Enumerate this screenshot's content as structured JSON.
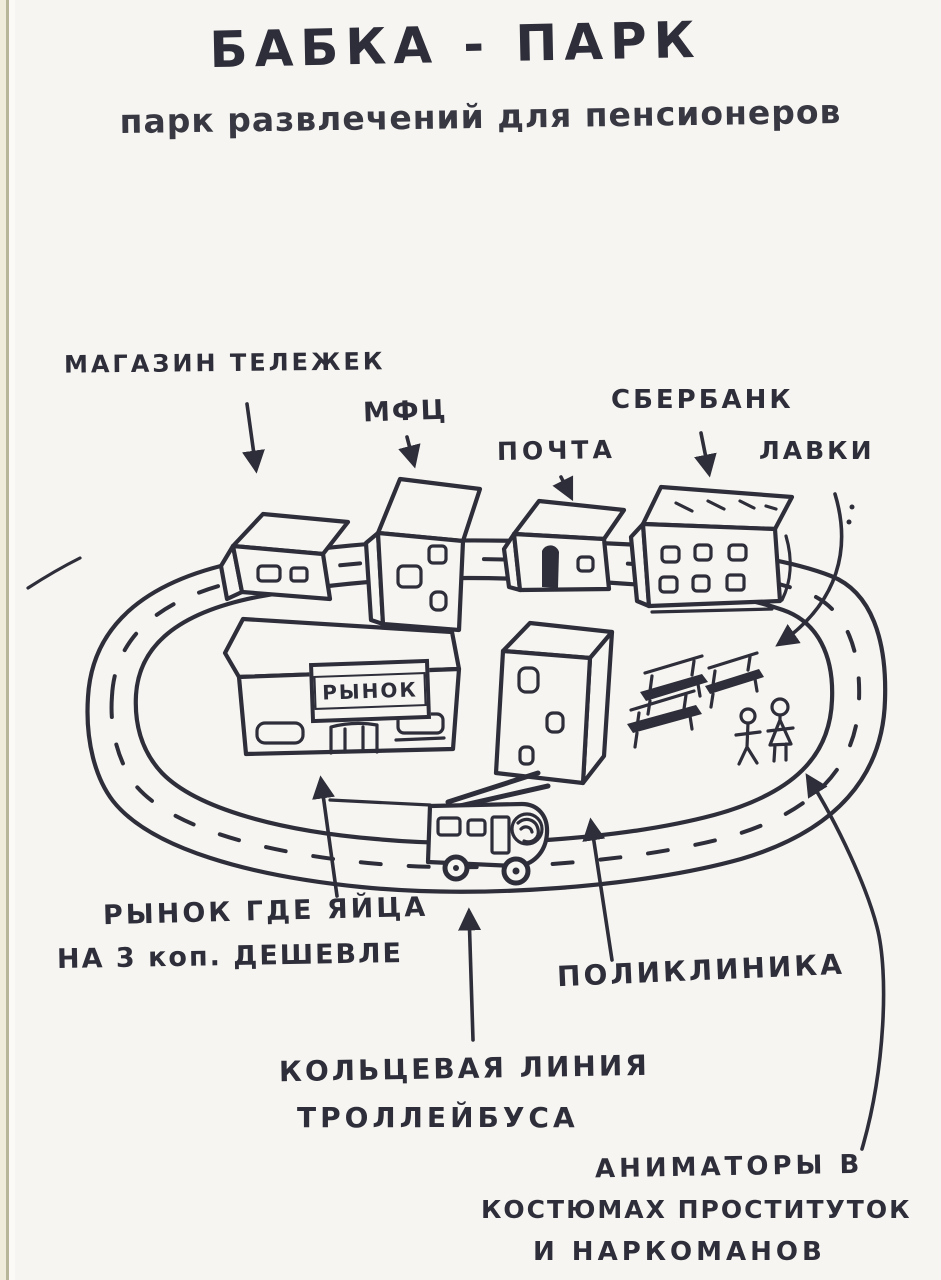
{
  "page": {
    "title": "БАБКА - ПАРК",
    "subtitle": "парк развлечений для пенсионеров",
    "colors": {
      "ink": "#2e2e3a",
      "paper": "#f6f5f1",
      "page_edge_strip": "#efecdb",
      "page_edge_line": "#b7b59a"
    }
  },
  "labels": {
    "cart_store": "МАГАЗИН ТЕЛЕЖЕК",
    "mfc": "МФЦ",
    "post_office": "ПОЧТА",
    "sberbank": "СБЕРБАНК",
    "benches": "ЛАВКИ",
    "market_sign": "РЫНОК",
    "market_note_line1": "РЫНОК ГДЕ ЯЙЦА",
    "market_note_line2": "НА 3 коп. ДЕШЕВЛЕ",
    "polyclinic": "ПОЛИКЛИНИКА",
    "ring_line_line1": "КОЛЬЦЕВАЯ ЛИНИЯ",
    "ring_line_line2": "ТРОЛЛЕЙБУСА",
    "animators_line1": "АНИМАТОРЫ В",
    "animators_line2": "КОСТЮМАХ ПРОСТИТУТОК",
    "animators_line3": "И НАРКОМАНОВ"
  }
}
